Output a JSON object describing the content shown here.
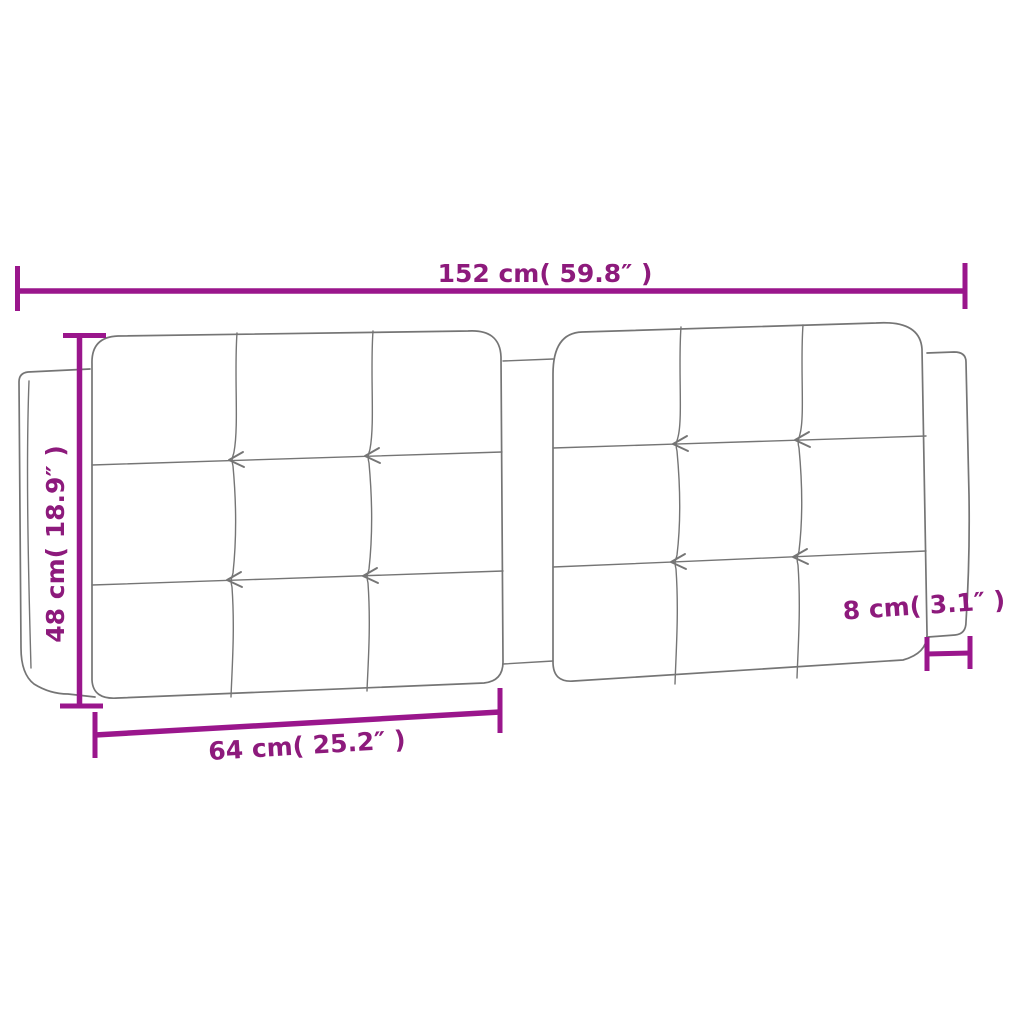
{
  "diagram": {
    "subject": "tufted-headboard-cushion-dimension-diagram",
    "colors": {
      "dimension": "#9a168c",
      "dimension_text": "#8d1a7c",
      "outline": "#757575",
      "background": "#ffffff"
    },
    "dimensions": {
      "total_width": {
        "label": "152 cm( 59.8″ )",
        "cm": "152",
        "inches": "59.8"
      },
      "height": {
        "label": "48 cm( 18.9″ )",
        "cm": "48",
        "inches": "18.9"
      },
      "panel_width": {
        "label": "64 cm( 25.2″ )",
        "cm": "64",
        "inches": "25.2"
      },
      "side_depth": {
        "label": "8 cm( 3.1″ )",
        "cm": "8",
        "inches": "3.1"
      }
    }
  }
}
